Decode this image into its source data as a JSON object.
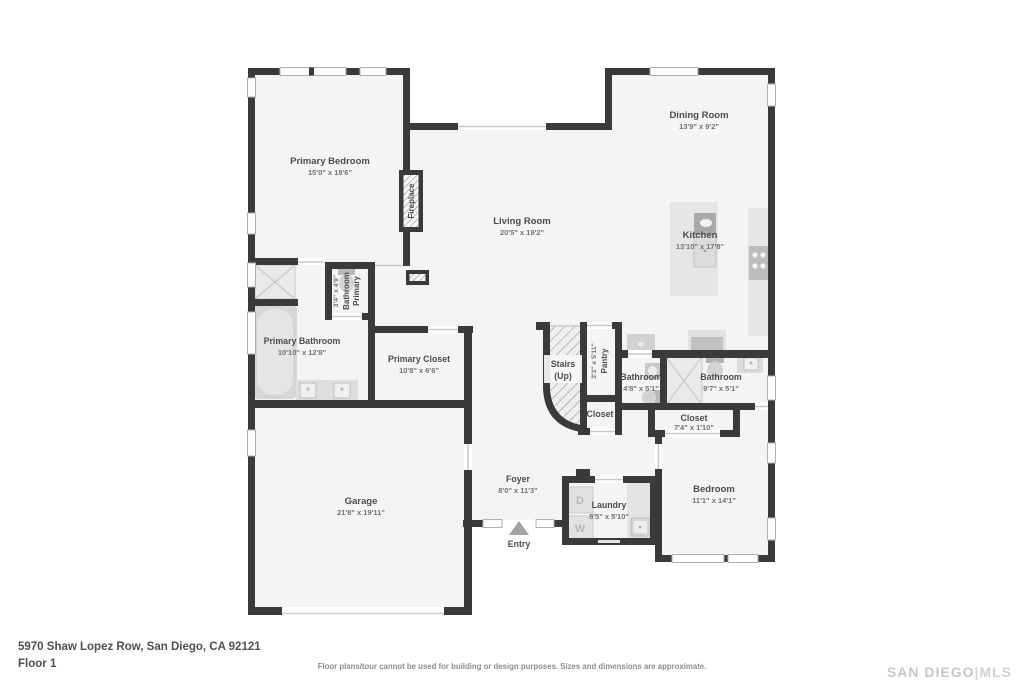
{
  "footer": {
    "address": "5970 Shaw Lopez Row, San Diego, CA 92121",
    "floor_label": "Floor 1",
    "disclaimer": "Floor plans/tour cannot be used for building or design purposes. Sizes and dimensions are approximate.",
    "brand": {
      "part1": "SAN DIEGO",
      "sep": "|",
      "part2": "MLS"
    }
  },
  "rooms": {
    "primary_bedroom": {
      "name": "Primary Bedroom",
      "dims": "15'0\" x 18'6\""
    },
    "living_room": {
      "name": "Living Room",
      "dims": "20'5\" x 19'2\""
    },
    "dining_room": {
      "name": "Dining Room",
      "dims": "13'9\" x 9'2\""
    },
    "kitchen": {
      "name": "Kitchen",
      "dims": "13'10\" x 17'8\""
    },
    "primary_bathroom": {
      "name": "Primary Bathroom",
      "dims": "10'10\" x 12'8\""
    },
    "primary_toilet": {
      "line1": "Primary",
      "line2": "Bathroom",
      "dims": "3'4\" x 4'9\""
    },
    "primary_closet": {
      "name": "Primary Closet",
      "dims": "10'8\" x 6'6\""
    },
    "pantry": {
      "name": "Pantry",
      "dims": "3'3\" x 5'11\""
    },
    "stairs": {
      "line1": "Stairs",
      "line2": "(Up)"
    },
    "stairs_closet": {
      "name": "Closet"
    },
    "bathroom_small": {
      "name": "Bathroom",
      "dims": "4'8\" x 5'1\""
    },
    "bathroom_large": {
      "name": "Bathroom",
      "dims": "9'7\" x 5'1\""
    },
    "bedroom_closet": {
      "name": "Closet",
      "dims": "7'4\" x 1'10\""
    },
    "bedroom": {
      "name": "Bedroom",
      "dims": "11'1\" x 14'1\""
    },
    "laundry": {
      "name": "Laundry",
      "dims": "8'5\" x 5'10\""
    },
    "foyer": {
      "name": "Foyer",
      "dims": "8'0\" x 11'3\""
    },
    "garage": {
      "name": "Garage",
      "dims": "21'8\" x 19'11\""
    },
    "entry": {
      "name": "Entry"
    },
    "fireplace": {
      "name": "Fireplace"
    }
  },
  "appliances": {
    "dryer": "D",
    "washer": "W",
    "fridge_glyph": "«"
  },
  "colors": {
    "wall": "#3a3a3a",
    "floor": "#f4f4f4",
    "fixture": "#e3e3e3",
    "label": "#4d4d4d"
  }
}
